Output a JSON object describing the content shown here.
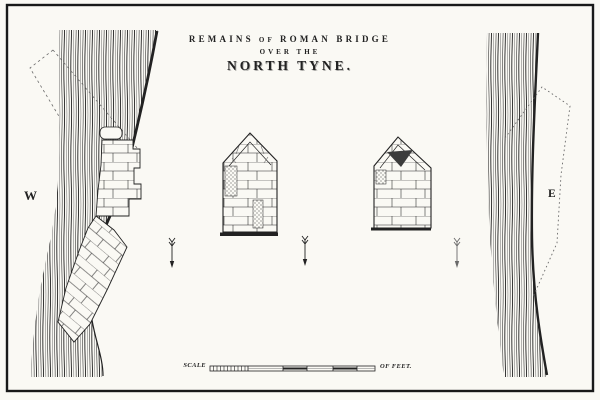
{
  "engraving": {
    "title": {
      "part1": "REMAINS",
      "part2": "OF",
      "part3": "ROMAN BRIDGE",
      "line2": "OVER THE",
      "line3": "NORTH TYNE."
    },
    "compass": {
      "west": "W",
      "east": "E"
    },
    "scale_bar": {
      "label": "SCALE",
      "units": "OF FEET."
    }
  },
  "colors": {
    "paper": "#faf9f4",
    "ink": "#222222",
    "ink_light": "#6a6a6a",
    "ink_shade": "#3c3c3c",
    "frame": "#191919"
  }
}
